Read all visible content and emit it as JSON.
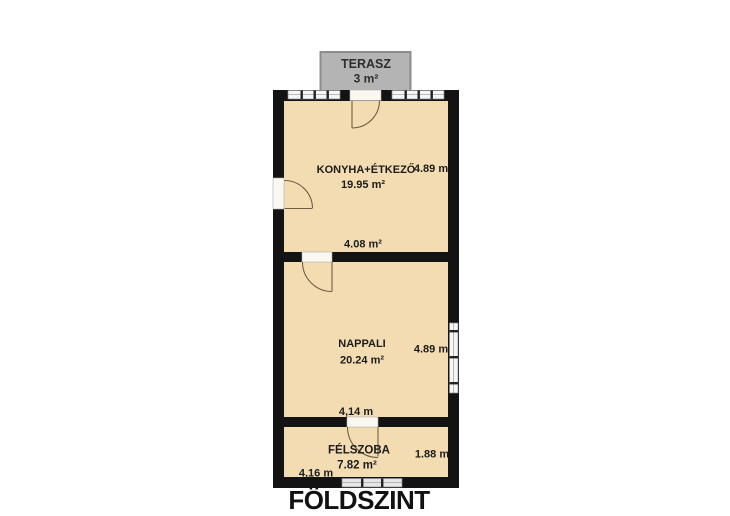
{
  "plan": {
    "title": "FÖLDSZINT"
  },
  "terrace": {
    "name": "TERASZ",
    "area": "3 m²"
  },
  "rooms": {
    "konyha": {
      "name": "KONYHA+ÉTKEZŐ",
      "area": "19.95 m²",
      "side_dim": "4.89 m",
      "bottom_dim": "4.08 m²"
    },
    "nappali": {
      "name": "NAPPALI",
      "area": "20.24 m²",
      "side_dim": "4.89 m",
      "bottom_dim": "4,14 m"
    },
    "felszoba": {
      "name": "FÉLSZOBA",
      "area": "7.82 m²",
      "side_dim": "1.88 m",
      "bottom_dim": "4,16 m"
    }
  },
  "colors": {
    "floor": "#f3dcb2",
    "wall": "#131313",
    "terrace_fill": "#b4b4b4",
    "terrace_border": "#8d8d8d",
    "window": "#f6f6f6",
    "door_swing": "#6e6046",
    "text": "#1c1c1c",
    "background": "#ffffff"
  }
}
